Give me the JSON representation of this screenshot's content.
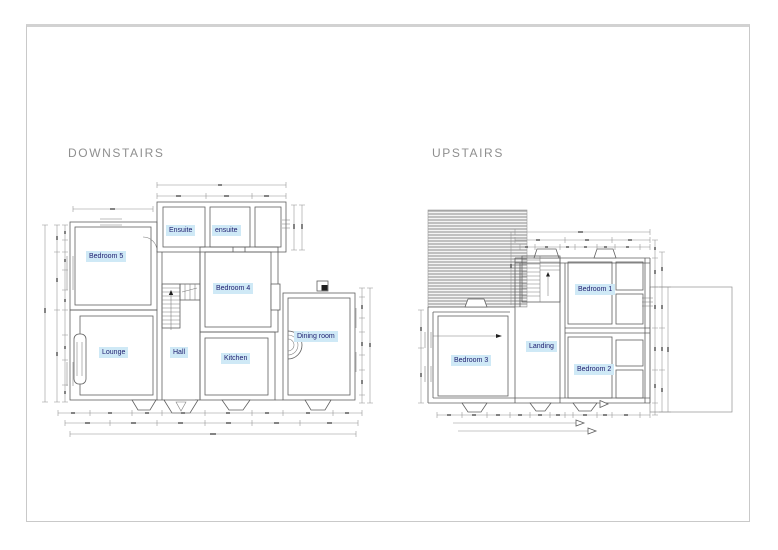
{
  "drawing": {
    "background": "#ffffff",
    "frame_color": "#c9c9c9",
    "wall_line_color": "#606060",
    "dimension_line_color": "#8f8f8f",
    "hatch_line_color": "#808080",
    "label_bg": "#cfe9f6",
    "label_text_color": "#1c1c6e",
    "title_color": "#8f8f8f"
  },
  "plans": {
    "downstairs": {
      "title": "DOWNSTAIRS",
      "rooms": [
        {
          "label": "Ensuite"
        },
        {
          "label": "ensuite"
        },
        {
          "label": "Bedroom 5"
        },
        {
          "label": "Bedroom 4"
        },
        {
          "label": "Lounge"
        },
        {
          "label": "Hall"
        },
        {
          "label": "Kitchen"
        },
        {
          "label": "Dining room"
        }
      ]
    },
    "upstairs": {
      "title": "UPSTAIRS",
      "rooms": [
        {
          "label": "Bedroom 1"
        },
        {
          "label": "Landing"
        },
        {
          "label": "Bedroom 3"
        },
        {
          "label": "Bedroom 2"
        }
      ]
    }
  }
}
